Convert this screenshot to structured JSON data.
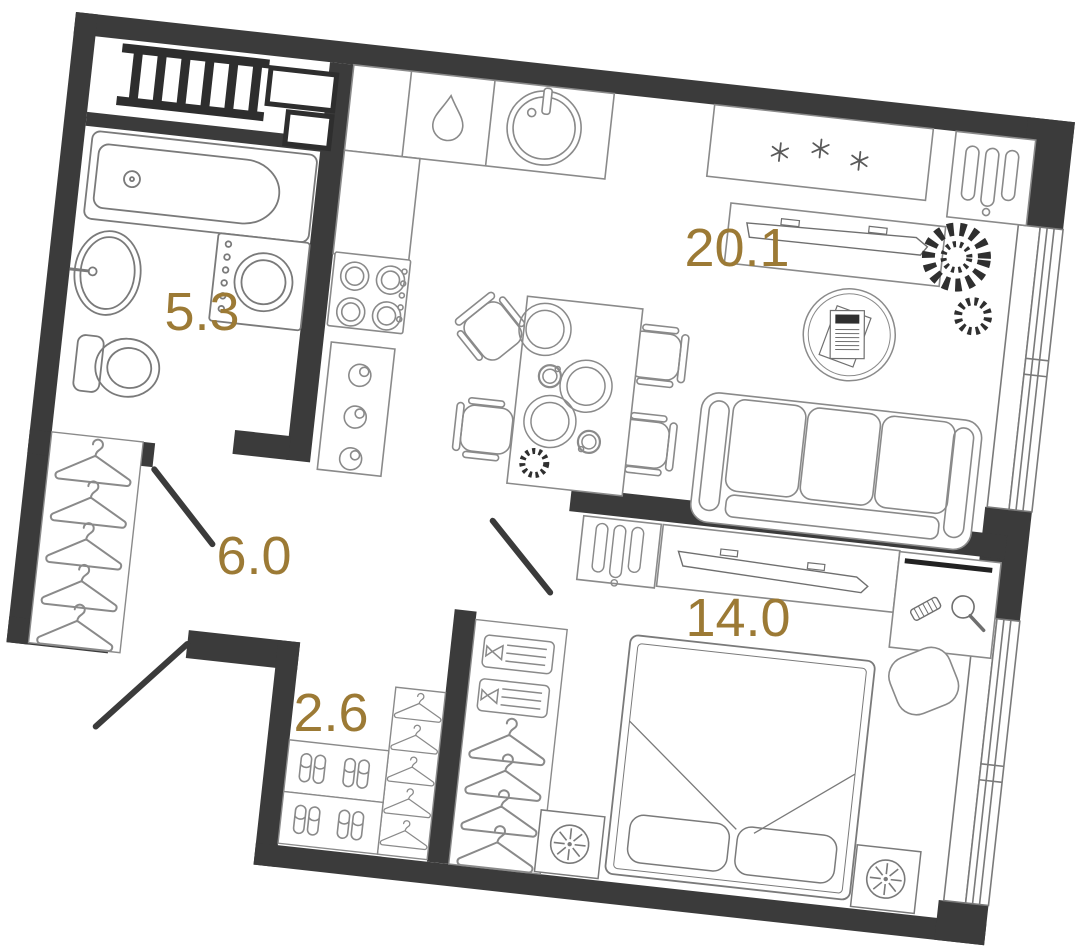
{
  "palette": {
    "wall": "#3b3b3b",
    "wall_dark": "#2e2e2e",
    "furniture_line": "#8a8a8a",
    "furniture_line_dark": "#6f6f6f",
    "label": "#9c7a35",
    "background": "#ffffff"
  },
  "floorplan": {
    "type": "apartment-floor-plan",
    "rotation_deg": 6.3,
    "rooms": [
      {
        "id": "bathroom",
        "area_label": "5.3"
      },
      {
        "id": "hallway",
        "area_label": "6.0"
      },
      {
        "id": "closet",
        "area_label": "2.6"
      },
      {
        "id": "living-kitchen",
        "area_label": "20.1"
      },
      {
        "id": "bedroom",
        "area_label": "14.0"
      }
    ],
    "furniture_icons": [
      "towel-radiator-icon",
      "bathtub-icon",
      "wash-basin-icon",
      "toilet-icon",
      "washing-machine-icon",
      "dishwasher-drop-icon",
      "kitchen-sink-icon",
      "hob-icon",
      "oven-knobs-icon",
      "fridge-snowflakes-icon",
      "wardrobe-slots-icon",
      "tv-console-icon",
      "sofa-icon",
      "dining-table-icon",
      "chair-icon",
      "plates-icon",
      "rug-magazines-icon",
      "plant-icon",
      "bed-icon",
      "pillow-icon",
      "nightstand-lamp-icon",
      "vanity-comb-icon",
      "vanity-mirror-icon",
      "stool-icon",
      "hanger-icon",
      "slippers-icon",
      "folded-clothes-icon",
      "window-icon",
      "door-leaf-icon"
    ]
  }
}
